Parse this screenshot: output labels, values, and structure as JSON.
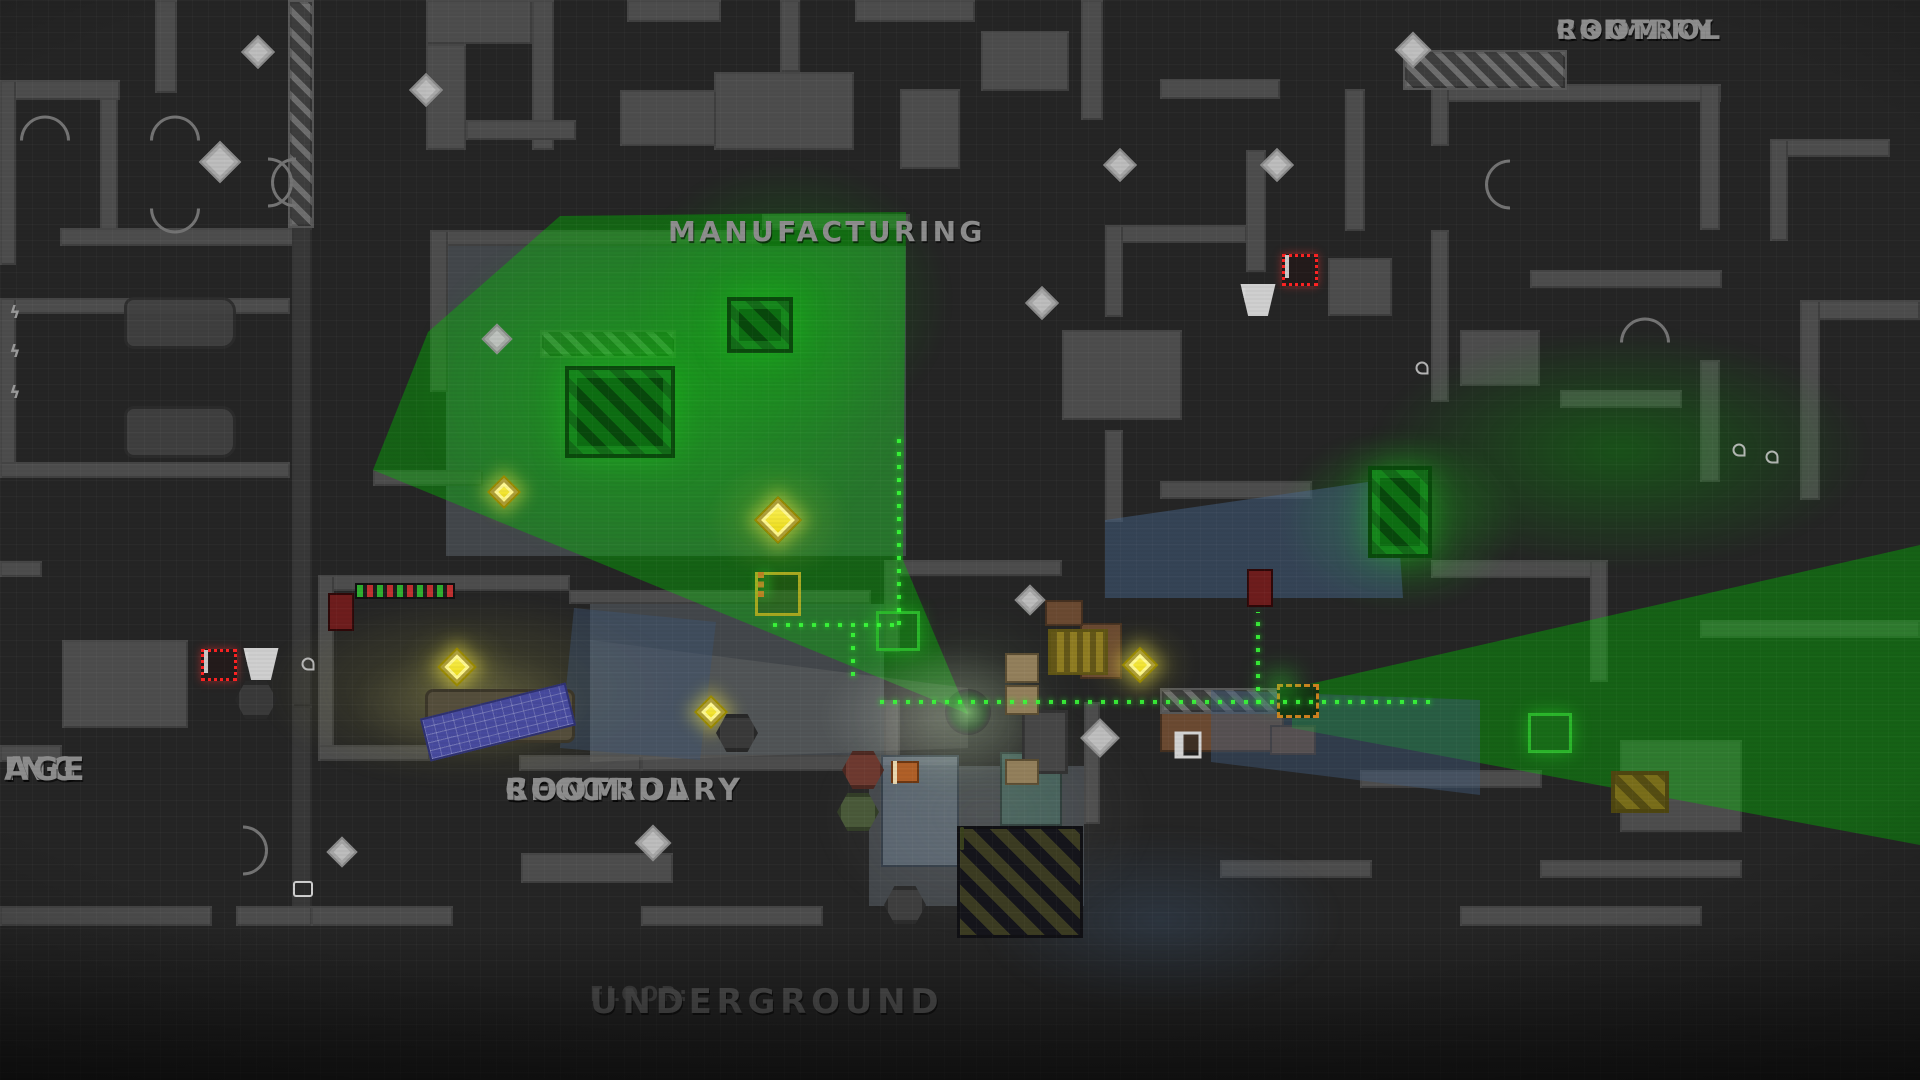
{
  "game_view": "top-down heist map",
  "floor": {
    "prefix": "FLOOR:",
    "name": "UNDERGROUND"
  },
  "rooms": [
    {
      "id": "primary-control-room",
      "lines": [
        "PRIMARY",
        "CONTROL",
        "ROOM"
      ],
      "x": 1556,
      "y": 16,
      "size": 27,
      "align": "center"
    },
    {
      "id": "manufacturing",
      "lines": [
        "MANUFACTURING"
      ],
      "x": 668,
      "y": 216,
      "size": 28,
      "align": "center"
    },
    {
      "id": "secondary-control-room",
      "lines": [
        "SECONDARY",
        "CONTROL",
        "ROOM"
      ],
      "x": 505,
      "y": 774,
      "size": 30,
      "align": "center"
    },
    {
      "id": "parking-garage-clipped",
      "lines": [
        "ING",
        "AGE"
      ],
      "x": 4,
      "y": 752,
      "size": 32,
      "align": "left"
    }
  ],
  "colors": {
    "background": "#252525",
    "wall": "#4d4d4d",
    "wall_dark": "#383838",
    "label_gray": "#8d8d8d",
    "floor_label_gray": "#515151",
    "coin_gold": "#f0dc00",
    "coin_blueprint": "#c6c6c6",
    "vision_green": "#00be00",
    "path_green": "#39ff39",
    "alarm_red": "#ff2222",
    "water_blue": "#46617d",
    "warm_room": "#969646",
    "player_green": "#17b517",
    "case_orange": "#d07020"
  },
  "scene": {
    "walls": [
      [
        155,
        0,
        22,
        93,
        0
      ],
      [
        0,
        80,
        120,
        20,
        0
      ],
      [
        0,
        80,
        16,
        185,
        0
      ],
      [
        100,
        98,
        18,
        148,
        0
      ],
      [
        60,
        228,
        250,
        18,
        0
      ],
      [
        288,
        0,
        26,
        228,
        2
      ],
      [
        292,
        228,
        20,
        478,
        1
      ],
      [
        292,
        706,
        20,
        205,
        1
      ],
      [
        0,
        298,
        290,
        16,
        0
      ],
      [
        0,
        298,
        16,
        180,
        0
      ],
      [
        0,
        462,
        290,
        16,
        0
      ],
      [
        0,
        561,
        42,
        16,
        0
      ],
      [
        62,
        640,
        126,
        88,
        0
      ],
      [
        0,
        745,
        62,
        17,
        0
      ],
      [
        0,
        906,
        212,
        20,
        0
      ],
      [
        236,
        906,
        76,
        20,
        0
      ],
      [
        426,
        0,
        106,
        44,
        0
      ],
      [
        532,
        0,
        22,
        150,
        0
      ],
      [
        627,
        0,
        94,
        22,
        0
      ],
      [
        714,
        72,
        140,
        78,
        0
      ],
      [
        620,
        90,
        96,
        56,
        0
      ],
      [
        426,
        44,
        40,
        106,
        0
      ],
      [
        466,
        120,
        110,
        20,
        0
      ],
      [
        780,
        0,
        20,
        72,
        0
      ],
      [
        855,
        0,
        120,
        22,
        0
      ],
      [
        981,
        31,
        88,
        60,
        0
      ],
      [
        1081,
        0,
        22,
        120,
        0
      ],
      [
        1160,
        79,
        120,
        20,
        0
      ],
      [
        900,
        89,
        60,
        80,
        0
      ],
      [
        446,
        246,
        460,
        310,
        7
      ],
      [
        590,
        604,
        294,
        152,
        7
      ],
      [
        869,
        766,
        215,
        140,
        7
      ],
      [
        430,
        230,
        332,
        16,
        0
      ],
      [
        762,
        214,
        148,
        16,
        0
      ],
      [
        430,
        230,
        18,
        162,
        0
      ],
      [
        373,
        470,
        110,
        16,
        0
      ],
      [
        540,
        330,
        136,
        28,
        2
      ],
      [
        330,
        575,
        240,
        16,
        0
      ],
      [
        569,
        590,
        302,
        14,
        0
      ],
      [
        318,
        575,
        16,
        186,
        0
      ],
      [
        318,
        745,
        112,
        16,
        0
      ],
      [
        519,
        755,
        122,
        16,
        0
      ],
      [
        641,
        755,
        242,
        16,
        0
      ],
      [
        884,
        560,
        16,
        92,
        0
      ],
      [
        884,
        700,
        16,
        62,
        0
      ],
      [
        900,
        560,
        162,
        16,
        0
      ],
      [
        311,
        906,
        142,
        20,
        0
      ],
      [
        521,
        853,
        152,
        30,
        0
      ],
      [
        641,
        906,
        182,
        20,
        0
      ],
      [
        1105,
        225,
        142,
        18,
        0
      ],
      [
        1105,
        225,
        18,
        92,
        0
      ],
      [
        1062,
        330,
        120,
        90,
        0
      ],
      [
        1246,
        150,
        20,
        122,
        0
      ],
      [
        1345,
        89,
        20,
        142,
        0
      ],
      [
        1431,
        84,
        290,
        18,
        0
      ],
      [
        1700,
        84,
        20,
        146,
        0
      ],
      [
        1431,
        84,
        18,
        62,
        0
      ],
      [
        1403,
        50,
        164,
        40,
        2
      ],
      [
        1328,
        258,
        64,
        58,
        0
      ],
      [
        1431,
        230,
        18,
        172,
        0
      ],
      [
        1530,
        270,
        192,
        18,
        0
      ],
      [
        1770,
        139,
        120,
        18,
        0
      ],
      [
        1770,
        139,
        18,
        102,
        0
      ],
      [
        1460,
        330,
        80,
        56,
        0
      ],
      [
        1560,
        390,
        122,
        18,
        0
      ],
      [
        1700,
        360,
        20,
        122,
        0
      ],
      [
        1800,
        300,
        120,
        20,
        0
      ],
      [
        1800,
        300,
        20,
        200,
        0
      ],
      [
        1105,
        430,
        18,
        92,
        0
      ],
      [
        1160,
        481,
        152,
        18,
        0
      ],
      [
        1431,
        560,
        162,
        18,
        0
      ],
      [
        1590,
        560,
        18,
        122,
        0
      ],
      [
        1700,
        620,
        220,
        18,
        0
      ],
      [
        1084,
        702,
        16,
        122,
        0
      ],
      [
        1360,
        770,
        182,
        18,
        0
      ],
      [
        1620,
        740,
        122,
        92,
        0
      ],
      [
        1540,
        860,
        202,
        18,
        0
      ],
      [
        1220,
        860,
        152,
        18,
        0
      ],
      [
        1460,
        906,
        242,
        20,
        0
      ],
      [
        1080,
        623,
        42,
        56,
        3
      ],
      [
        1160,
        708,
        124,
        44,
        3
      ],
      [
        1270,
        725,
        46,
        30,
        3
      ],
      [
        1045,
        600,
        38,
        26,
        3
      ],
      [
        881,
        755,
        78,
        112,
        5
      ],
      [
        1000,
        752,
        62,
        74,
        6
      ],
      [
        1160,
        688,
        124,
        26,
        2
      ]
    ],
    "lights": [
      {
        "type": "poly",
        "points": "968px 714px, 373px 470px, 428px 332px, 560px 216px, 906px 212px, 903px 560px",
        "color": "rgba(0,190,0,0.40)"
      },
      {
        "type": "ellipse",
        "x": 660,
        "y": 390,
        "rx": 250,
        "ry": 180,
        "color": "rgba(0,220,0,0.30)"
      },
      {
        "type": "ellipse",
        "x": 790,
        "y": 300,
        "rx": 160,
        "ry": 140,
        "color": "rgba(0,210,0,0.25)"
      },
      {
        "type": "poly",
        "points": "1292px 688px, 1920px 545px, 1920px 845px, 1292px 728px",
        "color": "rgba(0,200,0,0.38)"
      },
      {
        "type": "ellipse",
        "x": 1620,
        "y": 450,
        "rx": 250,
        "ry": 120,
        "color": "rgba(0,190,0,0.30)"
      },
      {
        "type": "ellipse",
        "x": 1400,
        "y": 520,
        "rx": 120,
        "ry": 90,
        "color": "rgba(20,230,20,0.33)"
      },
      {
        "type": "ellipse",
        "x": 470,
        "y": 690,
        "rx": 210,
        "ry": 95,
        "color": "rgba(150,150,70,0.30)"
      },
      {
        "type": "ellipse",
        "x": 470,
        "y": 705,
        "rx": 120,
        "ry": 55,
        "color": "rgba(215,205,130,0.22)"
      },
      {
        "type": "poly",
        "points": "590px 640px, 968px 688px, 968px 748px, 590px 762px",
        "color": "rgba(170,170,160,0.14)"
      },
      {
        "type": "ellipse",
        "x": 940,
        "y": 716,
        "rx": 120,
        "ry": 70,
        "color": "rgba(225,225,215,0.28)"
      },
      {
        "type": "poly",
        "stripes": true,
        "points": "1105px 520px, 1395px 478px, 1403px 598px, 1105px 598px",
        "color": "rgba(70,100,135,0.50)"
      },
      {
        "type": "poly",
        "stripes": true,
        "points": "1211px 690px, 1480px 700px, 1480px 795px, 1211px 762px",
        "color": "rgba(65,92,125,0.45)"
      },
      {
        "type": "poly",
        "stripes": true,
        "points": "574px 608px, 716px 622px, 700px 760px, 560px 748px",
        "color": "rgba(62,85,115,0.45)"
      },
      {
        "type": "ellipse",
        "x": 1160,
        "y": 920,
        "rx": 180,
        "ry": 90,
        "color": "rgba(60,85,115,0.35)"
      },
      {
        "type": "ellipse",
        "x": 985,
        "y": 815,
        "rx": 170,
        "ry": 120,
        "color": "rgba(170,170,165,0.13)"
      },
      {
        "type": "ellipse",
        "x": 778,
        "y": 520,
        "rx": 70,
        "ry": 60,
        "color": "rgba(230,230,60,0.18)"
      },
      {
        "type": "ellipse",
        "x": 457,
        "y": 667,
        "rx": 55,
        "ry": 45,
        "color": "rgba(230,230,60,0.15)"
      },
      {
        "type": "ellipse",
        "x": 1140,
        "y": 665,
        "rx": 55,
        "ry": 45,
        "color": "rgba(230,230,60,0.15)"
      }
    ],
    "paths": [
      {
        "x": 773,
        "y": 623,
        "len": 130,
        "dir": "h"
      },
      {
        "x": 897,
        "y": 432,
        "len": 193,
        "dir": "v"
      },
      {
        "x": 851,
        "y": 628,
        "len": 48,
        "dir": "v"
      },
      {
        "x": 880,
        "y": 700,
        "len": 550,
        "dir": "h"
      },
      {
        "x": 1256,
        "y": 612,
        "len": 92,
        "dir": "v"
      }
    ],
    "sprites": [
      {
        "t": "coinG",
        "x": 778,
        "y": 520,
        "s": 34
      },
      {
        "t": "coinG",
        "x": 457,
        "y": 667,
        "s": 28
      },
      {
        "t": "coinG",
        "x": 711,
        "y": 712,
        "s": 24
      },
      {
        "t": "coinG",
        "x": 1140,
        "y": 665,
        "s": 26
      },
      {
        "t": "coinG",
        "x": 504,
        "y": 492,
        "s": 24
      },
      {
        "t": "coinW",
        "x": 220,
        "y": 162,
        "s": 30
      },
      {
        "t": "coinW",
        "x": 258,
        "y": 52,
        "s": 24
      },
      {
        "t": "coinW",
        "x": 426,
        "y": 90,
        "s": 24
      },
      {
        "t": "coinW",
        "x": 497,
        "y": 339,
        "s": 22
      },
      {
        "t": "coinW",
        "x": 1042,
        "y": 303,
        "s": 24
      },
      {
        "t": "coinW",
        "x": 1120,
        "y": 165,
        "s": 24
      },
      {
        "t": "coinW",
        "x": 1277,
        "y": 165,
        "s": 24
      },
      {
        "t": "coinW",
        "x": 1413,
        "y": 50,
        "s": 26
      },
      {
        "t": "coinW",
        "x": 1030,
        "y": 600,
        "s": 22
      },
      {
        "t": "coinW",
        "x": 1100,
        "y": 738,
        "s": 28
      },
      {
        "t": "coinW",
        "x": 653,
        "y": 843,
        "s": 26
      },
      {
        "t": "coinW",
        "x": 342,
        "y": 852,
        "s": 22
      },
      {
        "t": "alarm",
        "x": 1300,
        "y": 270
      },
      {
        "t": "alarm",
        "x": 219,
        "y": 665
      },
      {
        "t": "warn",
        "x": 1258,
        "y": 300
      },
      {
        "t": "warn",
        "x": 261,
        "y": 664
      },
      {
        "t": "player",
        "x": 968,
        "y": 712
      },
      {
        "t": "car",
        "x": 180,
        "y": 323
      },
      {
        "t": "car",
        "x": 180,
        "y": 432
      },
      {
        "t": "fork",
        "x": 1078,
        "y": 652
      },
      {
        "t": "device",
        "x": 1298,
        "y": 701
      },
      {
        "t": "caseT",
        "x": 778,
        "y": 594
      },
      {
        "t": "caseD",
        "x": 898,
        "y": 631
      },
      {
        "t": "caseD",
        "x": 1550,
        "y": 733
      },
      {
        "t": "consoleR",
        "x": 341,
        "y": 612
      },
      {
        "t": "consoleR",
        "x": 1260,
        "y": 588
      },
      {
        "t": "machG",
        "x": 620,
        "y": 412,
        "w": 110,
        "h": 92
      },
      {
        "t": "machG",
        "x": 760,
        "y": 325,
        "w": 66,
        "h": 56
      },
      {
        "t": "machG",
        "x": 1400,
        "y": 512,
        "w": 64,
        "h": 92
      },
      {
        "t": "machY",
        "x": 1640,
        "y": 792,
        "w": 58,
        "h": 42
      },
      {
        "t": "machD",
        "x": 1020,
        "y": 882,
        "w": 126,
        "h": 112
      },
      {
        "t": "crate",
        "x": 1045,
        "y": 742,
        "w": 46,
        "h": 64
      },
      {
        "t": "hex",
        "x": 863,
        "y": 770,
        "c": "#6e3a30"
      },
      {
        "t": "hex",
        "x": 858,
        "y": 812,
        "c": "#4a5a3a"
      },
      {
        "t": "hex",
        "x": 256,
        "y": 700,
        "c": "#3a3a3a"
      },
      {
        "t": "hex",
        "x": 905,
        "y": 905,
        "c": "#3f3f3f"
      },
      {
        "t": "hex",
        "x": 737,
        "y": 733,
        "c": "#3a3a3a"
      },
      {
        "t": "table",
        "x": 500,
        "y": 716,
        "w": 150,
        "h": 54
      },
      {
        "t": "bp",
        "x": 498,
        "y": 722,
        "w": 150,
        "h": 44,
        "rot": -14
      },
      {
        "t": "strip",
        "x": 405,
        "y": 591,
        "w": 100,
        "h": 16
      },
      {
        "t": "locker",
        "x": 1022,
        "y": 668,
        "w": 34,
        "h": 30
      },
      {
        "t": "locker",
        "x": 1022,
        "y": 700,
        "w": 34,
        "h": 30
      },
      {
        "t": "locker",
        "x": 1022,
        "y": 772,
        "w": 34,
        "h": 26
      },
      {
        "t": "panel",
        "x": 1188,
        "y": 745
      },
      {
        "t": "plug",
        "x": 303,
        "y": 889
      },
      {
        "t": "spark",
        "x": 15,
        "y": 313,
        "g": "ϟ"
      },
      {
        "t": "spark",
        "x": 15,
        "y": 352,
        "g": "ϟ"
      },
      {
        "t": "spark",
        "x": 15,
        "y": 393,
        "g": "ϟ"
      },
      {
        "t": "valve",
        "x": 308,
        "y": 664
      },
      {
        "t": "valve",
        "x": 1739,
        "y": 450
      },
      {
        "t": "valve",
        "x": 1772,
        "y": 457
      },
      {
        "t": "valve",
        "x": 1422,
        "y": 368
      },
      {
        "t": "arc",
        "x": 175,
        "y": 128,
        "rot": 0
      },
      {
        "t": "arc",
        "x": 175,
        "y": 196,
        "rot": 180
      },
      {
        "t": "arc",
        "x": 268,
        "y": 170,
        "rot": 90
      },
      {
        "t": "arc",
        "x": 296,
        "y": 170,
        "rot": 270
      },
      {
        "t": "arc",
        "x": 1510,
        "y": 172,
        "rot": 270
      },
      {
        "t": "arc",
        "x": 1645,
        "y": 330,
        "rot": 0
      },
      {
        "t": "arc",
        "x": 243,
        "y": 838,
        "rot": 90
      },
      {
        "t": "arc",
        "x": 45,
        "y": 128,
        "rot": 0
      },
      {
        "t": "crateO",
        "x": 905,
        "y": 772
      }
    ]
  }
}
